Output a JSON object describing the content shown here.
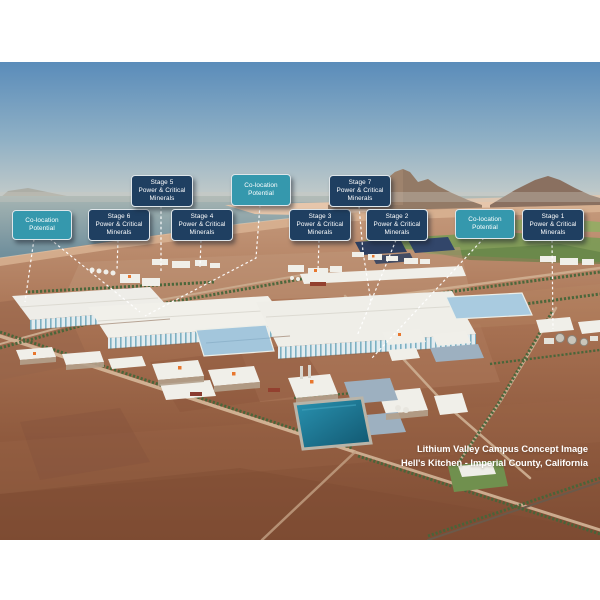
{
  "caption": {
    "line1": "Lithium Valley Campus Concept Image",
    "line2": "Hell's Kitchen - Imperial County, California"
  },
  "colors": {
    "stage_box": "#1f3f61",
    "colocation_box": "#3598ad",
    "box_border": "#dfe6ea",
    "leader_line": "#ffffff"
  },
  "callouts": [
    {
      "id": "colocation-left",
      "type": "colocation",
      "lines": [
        "Co-location",
        "Potential"
      ],
      "x": 12,
      "y": 210,
      "w": 58,
      "h": 28,
      "leaders": [
        [
          [
            34,
            239
          ],
          [
            25,
            302
          ]
        ],
        [
          [
            50,
            239
          ],
          [
            140,
            312
          ]
        ]
      ]
    },
    {
      "id": "stage-6",
      "type": "stage",
      "lines": [
        "Stage 6",
        "Power & Critical",
        "Minerals"
      ],
      "x": 88,
      "y": 209,
      "w": 60,
      "h": 30,
      "leaders": [
        [
          [
            118,
            240
          ],
          [
            117,
            270
          ]
        ]
      ]
    },
    {
      "id": "stage-5",
      "type": "stage",
      "lines": [
        "Stage 5",
        "Power & Critical",
        "Minerals"
      ],
      "x": 131,
      "y": 175,
      "w": 60,
      "h": 30,
      "leaders": [
        [
          [
            161,
            206
          ],
          [
            161,
            271
          ]
        ]
      ]
    },
    {
      "id": "stage-4",
      "type": "stage",
      "lines": [
        "Stage 4",
        "Power & Critical",
        "Minerals"
      ],
      "x": 171,
      "y": 209,
      "w": 60,
      "h": 30,
      "leaders": [
        [
          [
            201,
            240
          ],
          [
            200,
            267
          ]
        ]
      ]
    },
    {
      "id": "colocation-top",
      "type": "colocation",
      "lines": [
        "Co-location",
        "Potential"
      ],
      "x": 231,
      "y": 174,
      "w": 58,
      "h": 30,
      "leaders": [
        [
          [
            260,
            205
          ],
          [
            256,
            258
          ],
          [
            145,
            316
          ]
        ]
      ]
    },
    {
      "id": "stage-3",
      "type": "stage",
      "lines": [
        "Stage 3",
        "Power & Critical",
        "Minerals"
      ],
      "x": 289,
      "y": 209,
      "w": 60,
      "h": 30,
      "leaders": [
        [
          [
            319,
            240
          ],
          [
            318,
            272
          ]
        ]
      ]
    },
    {
      "id": "stage-7",
      "type": "stage",
      "lines": [
        "Stage 7",
        "Power & Critical",
        "Minerals"
      ],
      "x": 329,
      "y": 175,
      "w": 60,
      "h": 30,
      "leaders": [
        [
          [
            359,
            206
          ],
          [
            363,
            252
          ],
          [
            371,
            302
          ]
        ]
      ]
    },
    {
      "id": "stage-2",
      "type": "stage",
      "lines": [
        "Stage 2",
        "Power & Critical",
        "Minerals"
      ],
      "x": 366,
      "y": 209,
      "w": 60,
      "h": 30,
      "leaders": [
        [
          [
            396,
            240
          ],
          [
            357,
            336
          ]
        ]
      ]
    },
    {
      "id": "colocation-right",
      "type": "colocation",
      "lines": [
        "Co-location",
        "Potential"
      ],
      "x": 455,
      "y": 209,
      "w": 58,
      "h": 28,
      "leaders": [
        [
          [
            484,
            238
          ],
          [
            372,
            358
          ]
        ]
      ]
    },
    {
      "id": "stage-1",
      "type": "stage",
      "lines": [
        "Stage 1",
        "Power & Critical",
        "Minerals"
      ],
      "x": 522,
      "y": 209,
      "w": 60,
      "h": 30,
      "leaders": [
        [
          [
            552,
            240
          ],
          [
            553,
            329
          ]
        ]
      ]
    }
  ]
}
